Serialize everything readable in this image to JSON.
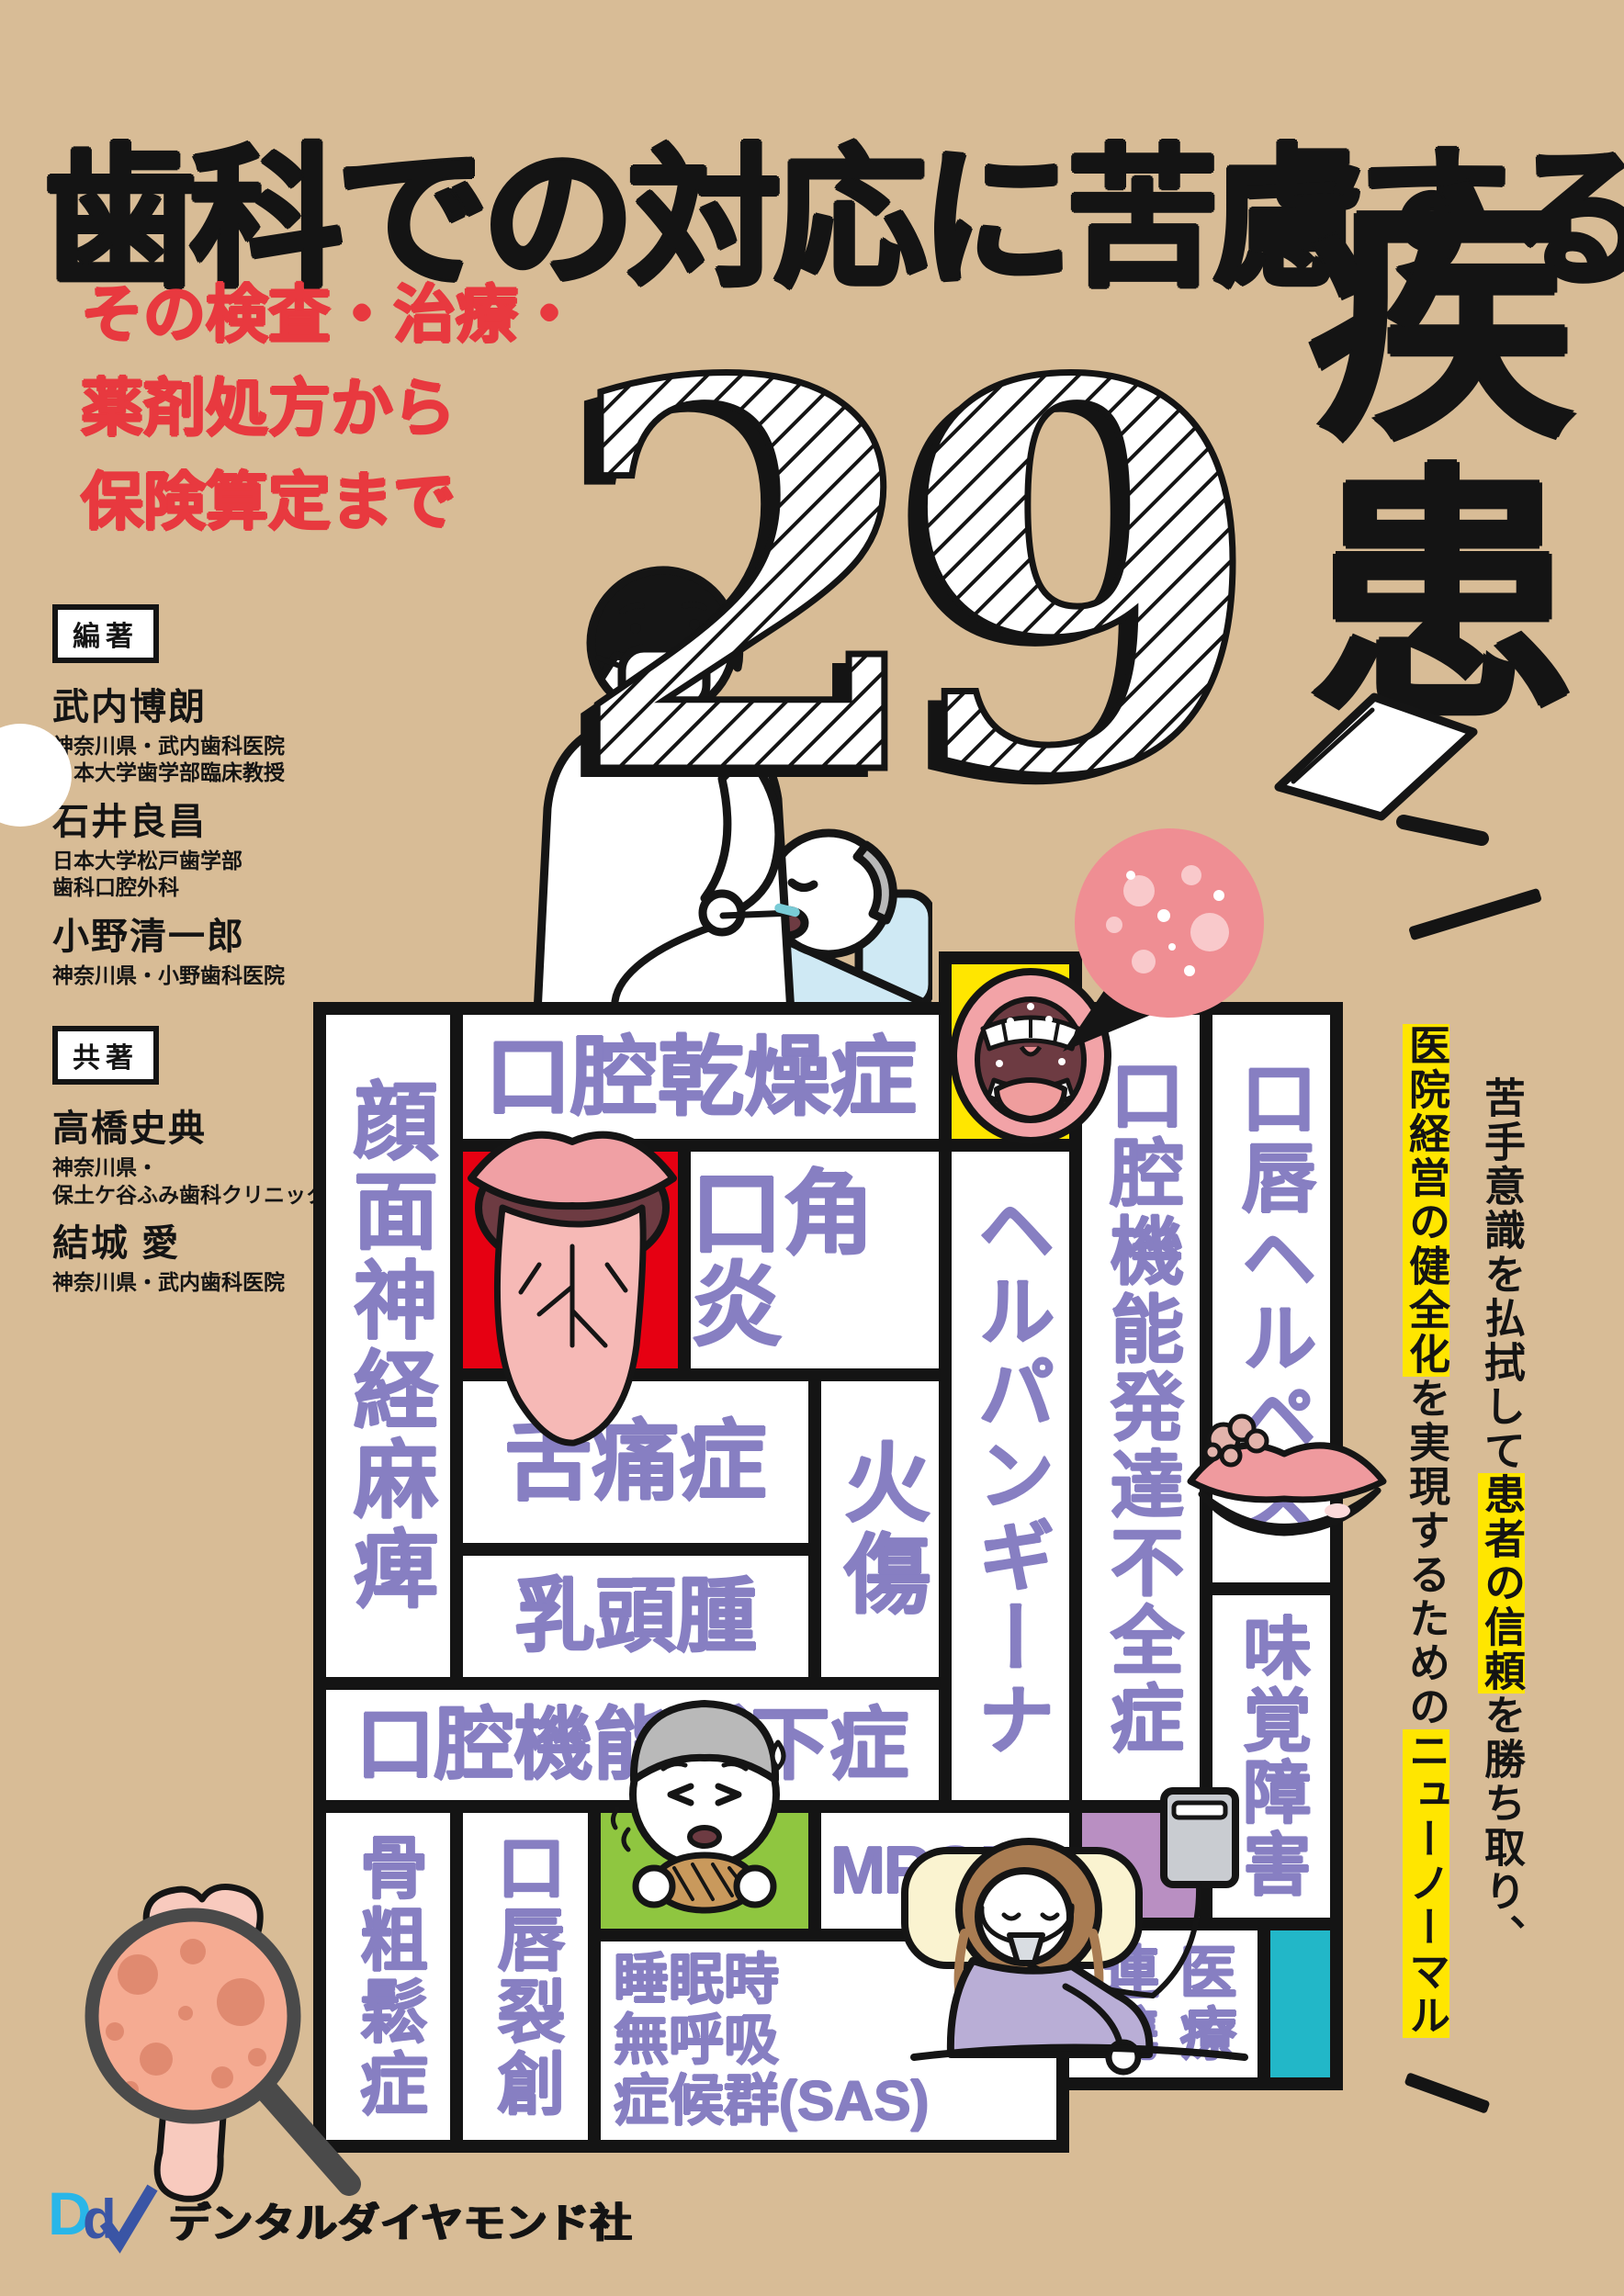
{
  "colors": {
    "background": "#d8bc96",
    "ink": "#141414",
    "accent_red": "#e8393f",
    "disease_purple": "#877fc2",
    "cell_red": "#e60012",
    "cell_yellow": "#ffe600",
    "cell_green": "#8fc640",
    "cell_purple": "#b98fc2",
    "cell_teal": "#22b7c8",
    "highlight_yellow": "#ffe600",
    "logo_cyan": "#29b6e8",
    "logo_blue": "#3a55a5"
  },
  "header": {
    "title": "歯科での対応に苦慮する",
    "subtitle_lines": [
      "その検査・治療・",
      "薬剤処方から",
      "保険算定まで"
    ],
    "big_number": "29",
    "big_number_unit": "疾患"
  },
  "authors": {
    "editors_badge": "編著",
    "editors": [
      {
        "name": "武内博朗",
        "aff": [
          "神奈川県・武内歯科医院",
          "日本大学歯学部臨床教授"
        ]
      },
      {
        "name": "石井良昌",
        "aff": [
          "日本大学松戸歯学部",
          "歯科口腔外科"
        ]
      },
      {
        "name": "小野清一郎",
        "aff": [
          "神奈川県・小野歯科医院"
        ]
      }
    ],
    "coauthors_badge": "共著",
    "coauthors": [
      {
        "name": "高橋史典",
        "aff": [
          "神奈川県・",
          "保土ケ谷ふみ歯科クリニック"
        ]
      },
      {
        "name": "結城 愛",
        "aff": [
          "神奈川県・武内歯科医院"
        ]
      }
    ]
  },
  "tagline": {
    "col_right": {
      "pre": "苦手意識を払拭して",
      "highlight": "患者の信頼",
      "post": "を勝ち取り、"
    },
    "col_left": {
      "highlight1": "医院経営の健全化",
      "mid": "を実現するための",
      "highlight2": "ニューノーマル"
    }
  },
  "grid": {
    "facial_nerve": "顔面神経麻痺",
    "dry_mouth": "口腔乾燥症",
    "angular_cheilitis": "口角炎",
    "glossodynia": "舌痛症",
    "papilloma": "乳頭腫",
    "burn": "火傷",
    "herpangina": "ヘルパンギーナ",
    "oral_hypofunction": "口腔機能低下症",
    "osteoporosis": "骨粗鬆症",
    "lip_laceration": "口唇裂創",
    "mronj": "MRONJ",
    "sas_lines": [
      "睡眠時",
      "無呼吸",
      "症候群(SAS)"
    ],
    "developmental_insufficiency": "口腔機能発達不全症",
    "labial_herpes": "口唇ヘルペス",
    "taste_disorder": "味覚障害",
    "medical_col_left": "連携",
    "medical_col_right": "医療"
  },
  "publisher": {
    "logo_letters": [
      "D",
      "d"
    ],
    "name": "デンタルダイヤモンド社"
  }
}
